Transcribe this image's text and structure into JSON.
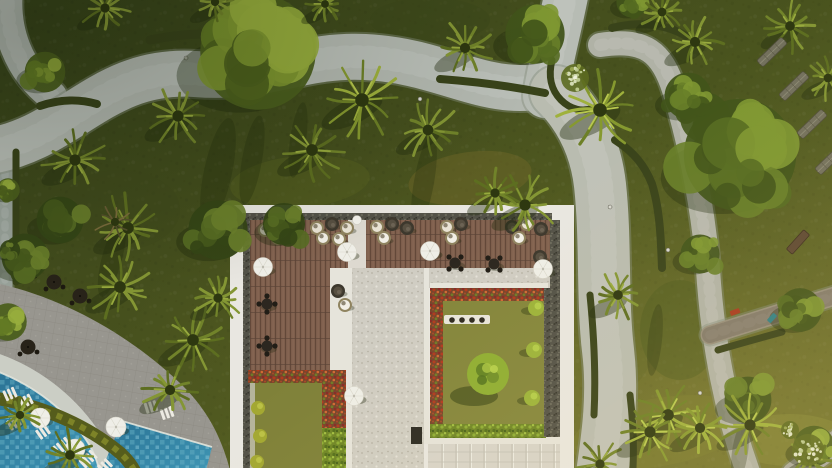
{
  "scene": {
    "type": "aerial-photograph",
    "subject": "tropical resort garden with rooftop terrace and swimming pool, top-down drone view",
    "palette": {
      "lawn_dark": "#37431a",
      "lawn_mid": "#4e581f",
      "lawn_light": "#686d2a",
      "path_gray": "#b6bab2",
      "path_edge": "#858d7c",
      "hedge_dark": "#39431a",
      "hedge_band": "#555c1c",
      "hedge_band_hi": "#878d2b",
      "plaza_paver": "#98968f",
      "pool_deep": "#2a7294",
      "pool_light": "#3f97b6",
      "pool_tile": "#8fcbdc",
      "building_white": "#e9e7e1",
      "pebble_border": "#535248",
      "deck_wood": "#7d5e4c",
      "marble_stone": "#d0cdc3",
      "red_flower_hedge": "#b23a1f",
      "green_hedge": "#6f8626",
      "courtyard_grass_left": "#7f8139",
      "courtyard_grass_right": "#84863c",
      "topiary_green": "#8fae33",
      "pod_cream": "#e9e3d4",
      "pod_dark": "#3d382d",
      "pod_ring": "#8f835f",
      "umbrella_white": "#efeee7",
      "umbrella_dark": "#282319",
      "lounger_white": "#eceae2",
      "sun_lounger_gray": "#72705d",
      "boardwalk": "#968e7c"
    },
    "paths": [
      {
        "name": "left-edge-path",
        "d": "M 5,146 L 5,292",
        "w": 15,
        "c": "#9aa39b"
      },
      {
        "name": "corner-stub-path",
        "d": "M 8,-10 C 4,30 18,70 52,96",
        "w": 30,
        "c": "#aeb4ac"
      },
      {
        "name": "main-winding-path",
        "d": "M -16,152 C 70,140 100,68 195,74 C 268,80 300,54 365,57 C 432,60 472,88 520,88 C 534,88 548,87 558,82",
        "w": 46,
        "c": "#b4b9b1"
      },
      {
        "name": "fork-top-path",
        "d": "M 545,96 C 551,60 560,28 568,-14",
        "w": 44,
        "c": "#b7bcb4"
      },
      {
        "name": "broad-south-path",
        "d": "M 556,92 C 582,118 596,150 600,185 C 606,240 602,300 608,350 C 614,400 606,445 602,474",
        "w": 52,
        "c": "#b9bcb0"
      },
      {
        "name": "east-diagonal-path",
        "d": "M 600,45 C 645,38 662,52 674,90 C 692,150 704,215 708,270 C 712,330 722,400 748,472",
        "w": 24,
        "c": "#b0b2a6"
      },
      {
        "name": "boardwalk",
        "d": "M 710,335 L 838,295",
        "w": 19,
        "c": "#968e7c"
      },
      {
        "name": "corner-path",
        "d": "M 794,474 L 840,440",
        "w": 24,
        "c": "#a8a89e"
      }
    ],
    "hedges": [
      {
        "d": "M 150,40 C 195,31 225,33 255,39",
        "w": 9
      },
      {
        "d": "M 16,152 L 16,282",
        "w": 7
      },
      {
        "d": "M 40,106 C 60,99 80,99 97,104",
        "w": 8
      },
      {
        "d": "M 440,79 C 480,82 515,87 545,93",
        "w": 8
      },
      {
        "d": "M 552,60 C 548,76 551,90 561,100 C 571,110 583,112 593,108",
        "w": 7
      },
      {
        "d": "M 612,28 C 640,21 666,24 686,36",
        "w": 8
      },
      {
        "d": "M 615,140 C 634,152 645,166 652,184 C 660,210 661,240 662,268",
        "w": 8
      },
      {
        "d": "M 590,295 C 594,335 596,375 594,415",
        "w": 7
      },
      {
        "d": "M 630,395 C 633,420 634,445 633,468",
        "w": 7
      },
      {
        "d": "M 718,350 C 738,344 760,338 782,332",
        "w": 7
      }
    ],
    "grass_patches": [
      [
        470,
        178,
        62,
        26,
        -8,
        "#6e6527",
        0.5
      ],
      [
        300,
        182,
        70,
        26,
        -5,
        "#55601f",
        0.5
      ],
      [
        660,
        432,
        90,
        34,
        -10,
        "#7a7c2e",
        0.5
      ],
      [
        620,
        330,
        36,
        60,
        0,
        "#5e6625",
        0.4
      ],
      [
        790,
        440,
        60,
        26,
        0,
        "#8a8c3a",
        0.45
      ],
      [
        120,
        210,
        60,
        40,
        0,
        "#3f4a1b",
        0.5
      ],
      [
        430,
        20,
        60,
        22,
        0,
        "#3c471a",
        0.5
      ],
      [
        680,
        330,
        40,
        50,
        0,
        "#4c5a1e",
        0.4
      ]
    ],
    "shadow_streaks": [
      [
        218,
        172,
        14,
        55,
        12
      ],
      [
        252,
        160,
        10,
        45,
        10
      ],
      [
        298,
        140,
        8,
        38,
        8
      ],
      [
        424,
        182,
        10,
        48,
        10
      ],
      [
        527,
        232,
        8,
        30,
        8
      ],
      [
        470,
        398,
        6,
        34,
        4
      ],
      [
        452,
        388,
        5,
        30,
        4
      ],
      [
        270,
        424,
        5,
        30,
        4
      ],
      [
        112,
        258,
        10,
        40,
        15
      ],
      [
        655,
        340,
        7,
        36,
        6
      ],
      [
        740,
        452,
        8,
        30,
        8
      ]
    ],
    "trees": [
      [
        258,
        52,
        74,
        1
      ],
      [
        45,
        72,
        26,
        1
      ],
      [
        60,
        220,
        30,
        2
      ],
      [
        218,
        230,
        38,
        2
      ],
      [
        284,
        224,
        27,
        2
      ],
      [
        535,
        34,
        38,
        0
      ],
      [
        740,
        155,
        72,
        0
      ],
      [
        688,
        96,
        30,
        0
      ],
      [
        700,
        254,
        25,
        0
      ],
      [
        800,
        310,
        28,
        0
      ],
      [
        748,
        400,
        30,
        0
      ],
      [
        814,
        446,
        26,
        1
      ],
      [
        25,
        257,
        30,
        2
      ],
      [
        8,
        322,
        24,
        1
      ],
      [
        632,
        2,
        20,
        0
      ],
      [
        8,
        190,
        15,
        1
      ],
      [
        10,
        250,
        13,
        2
      ]
    ],
    "palms": [
      [
        105,
        8,
        26,
        1
      ],
      [
        215,
        2,
        22,
        1
      ],
      [
        325,
        4,
        20,
        1
      ],
      [
        178,
        116,
        34,
        1
      ],
      [
        75,
        160,
        34,
        1
      ],
      [
        128,
        228,
        36,
        1
      ],
      [
        362,
        100,
        44,
        2
      ],
      [
        312,
        150,
        36,
        1
      ],
      [
        465,
        48,
        30,
        1
      ],
      [
        428,
        130,
        32,
        1
      ],
      [
        600,
        110,
        44,
        2
      ],
      [
        695,
        42,
        30,
        1
      ],
      [
        790,
        26,
        28,
        1
      ],
      [
        828,
        78,
        24,
        1
      ],
      [
        662,
        12,
        24,
        1
      ],
      [
        525,
        205,
        34,
        1
      ],
      [
        495,
        193,
        26,
        1
      ],
      [
        618,
        295,
        28,
        1
      ],
      [
        668,
        415,
        36,
        2
      ],
      [
        750,
        425,
        34,
        2
      ],
      [
        810,
        458,
        26,
        1
      ],
      [
        600,
        464,
        26,
        1
      ],
      [
        650,
        432,
        34,
        2
      ],
      [
        700,
        428,
        30,
        2
      ],
      [
        120,
        287,
        36,
        1
      ],
      [
        193,
        340,
        36,
        1
      ],
      [
        170,
        390,
        30,
        1
      ],
      [
        70,
        455,
        28,
        1
      ],
      [
        218,
        298,
        26,
        1
      ],
      [
        20,
        415,
        22,
        1
      ],
      [
        115,
        222,
        22,
        3
      ]
    ],
    "pool_area": {
      "plaza_d": "M 0,284 C 70,300 136,340 183,386 C 208,411 222,438 231,474 L -4,474 Z",
      "coping_d": "M -6,361 C 38,376 73,406 95,441 C 99,450 102,460 104,472",
      "pool1_d": "M -6,370 C 36,386 70,413 90,446 C 95,455 98,463 100,474 L -6,474 Z",
      "pool1_edge_d": "M -6,370 C 36,386 70,413 90,446 C 95,455 98,463 100,474",
      "pool2_points": "122,421 212,447 205,474 100,474",
      "pool2_edge_d": "M 122,421 L 212,447",
      "hedge_band_d": "M -6,398 C 46,406 90,428 119,452 C 126,458 132,465 136,474",
      "lounger_groups": [
        [
          10,
          394,
          -24,
          3
        ],
        [
          26,
          401,
          -27,
          3
        ],
        [
          14,
          423,
          -31,
          3
        ],
        [
          43,
          432,
          -35,
          3
        ],
        [
          62,
          446,
          -39,
          4
        ],
        [
          88,
          459,
          -43,
          4
        ],
        [
          105,
          466,
          -44,
          3
        ],
        [
          151,
          407,
          -17,
          3
        ],
        [
          167,
          413,
          -19,
          3
        ],
        [
          119,
          431,
          -33,
          2
        ]
      ],
      "white_umbrellas": [
        [
          40,
          418
        ],
        [
          75,
          449
        ],
        [
          116,
          427
        ]
      ],
      "dark_umbrellas": [
        [
          26,
          271
        ],
        [
          54,
          282
        ],
        [
          80,
          296
        ],
        [
          28,
          347
        ]
      ]
    },
    "building": {
      "frame": [
        230,
        205,
        344,
        263
      ],
      "pebble_strips": [
        [
          243,
          213,
          309,
          7
        ],
        [
          243,
          220,
          7,
          252
        ],
        [
          548,
          220,
          12,
          218
        ]
      ],
      "wood_deck": [
        [
          250,
          220,
          300,
          48
        ],
        [
          250,
          268,
          80,
          104
        ]
      ],
      "divider": [
        348,
        220,
        18,
        50
      ],
      "marble": [
        [
          366,
          268,
          184,
          20
        ],
        [
          352,
          268,
          72,
          206
        ]
      ],
      "white_strips": [
        [
          330,
          268,
          16,
          104
        ],
        [
          346,
          268,
          6,
          206
        ],
        [
          424,
          268,
          5,
          176
        ],
        [
          430,
          283,
          118,
          6
        ],
        [
          428,
          437,
          132,
          8
        ]
      ],
      "left_court": {
        "grass": [
          250,
          372,
          72,
          96
        ],
        "band": [
          250,
          372,
          5,
          96
        ],
        "red_top": [
          248,
          370,
          90,
          13
        ],
        "red_side": [
          322,
          370,
          24,
          58
        ],
        "green_side": [
          322,
          428,
          24,
          46
        ]
      },
      "right_court": {
        "grass": [
          443,
          301,
          103,
          123
        ],
        "red_top": [
          430,
          288,
          118,
          13
        ],
        "red_left": [
          430,
          288,
          13,
          149
        ],
        "green_bottom": [
          430,
          424,
          116,
          14
        ],
        "gravel": [
          544,
          288,
          16,
          149
        ]
      },
      "skylight": {
        "rect": [
          428,
          444,
          132,
          30
        ],
        "vx": [
          442,
          456,
          470,
          484,
          498,
          512,
          526,
          540,
          554
        ],
        "hy": [
          452,
          462
        ]
      },
      "bench": {
        "rect": [
          444,
          315,
          46,
          9
        ],
        "bowls": [
          [
            452,
            320
          ],
          [
            462,
            320
          ],
          [
            472,
            320
          ],
          [
            482,
            320
          ]
        ]
      },
      "round_bush": {
        "x": 488,
        "y": 374,
        "r": 21
      },
      "small_bushes_right": [
        [
          536,
          308
        ],
        [
          534,
          350
        ],
        [
          532,
          398
        ]
      ],
      "small_bushes_left": [
        [
          258,
          408
        ],
        [
          260,
          436
        ],
        [
          257,
          462
        ]
      ],
      "dark_box": [
        411,
        427,
        11,
        17
      ]
    },
    "furniture": {
      "pods": [
        [
          265,
          230,
          "c"
        ],
        [
          280,
          224,
          "d"
        ],
        [
          295,
          229,
          "c"
        ],
        [
          278,
          238,
          "w"
        ],
        [
          317,
          228,
          "c"
        ],
        [
          332,
          224,
          "d"
        ],
        [
          347,
          228,
          "c"
        ],
        [
          323,
          238,
          "w"
        ],
        [
          339,
          239,
          "w"
        ],
        [
          377,
          227,
          "c"
        ],
        [
          392,
          224,
          "d"
        ],
        [
          407,
          228,
          "d"
        ],
        [
          384,
          238,
          "w"
        ],
        [
          447,
          227,
          "c"
        ],
        [
          461,
          224,
          "d"
        ],
        [
          452,
          238,
          "w"
        ],
        [
          512,
          227,
          "d"
        ],
        [
          527,
          224,
          "c"
        ],
        [
          541,
          229,
          "d"
        ],
        [
          519,
          238,
          "w"
        ],
        [
          540,
          257,
          "d"
        ],
        [
          338,
          291,
          "d"
        ],
        [
          345,
          305,
          "w"
        ]
      ],
      "tables": [
        [
          267,
          304,
          0
        ],
        [
          267,
          346,
          0
        ],
        [
          455,
          263,
          1
        ],
        [
          494,
          264,
          1
        ]
      ],
      "white_umbrellas": [
        [
          347,
          252
        ],
        [
          430,
          251
        ],
        [
          263,
          267
        ],
        [
          354,
          396
        ],
        [
          543,
          269
        ]
      ],
      "white_ball": [
        357,
        220
      ]
    },
    "misc": {
      "sun_loungers": [
        [
          772,
          52,
          -44
        ],
        [
          794,
          86,
          -44
        ],
        [
          812,
          124,
          -44
        ],
        [
          830,
          160,
          -44
        ]
      ],
      "benches": [
        [
          798,
          242,
          -48
        ]
      ],
      "small_items": [
        [
          735,
          312,
          -20,
          "#a63b20"
        ],
        [
          772,
          318,
          -48,
          "#2f7f85"
        ]
      ],
      "flower_shrubs": [
        [
          808,
          450,
          16
        ],
        [
          790,
          430,
          9
        ],
        [
          575,
          78,
          14
        ]
      ],
      "lamps": [
        [
          420,
          99
        ],
        [
          610,
          207
        ],
        [
          668,
          250
        ],
        [
          700,
          393
        ],
        [
          186,
          58
        ]
      ]
    }
  }
}
